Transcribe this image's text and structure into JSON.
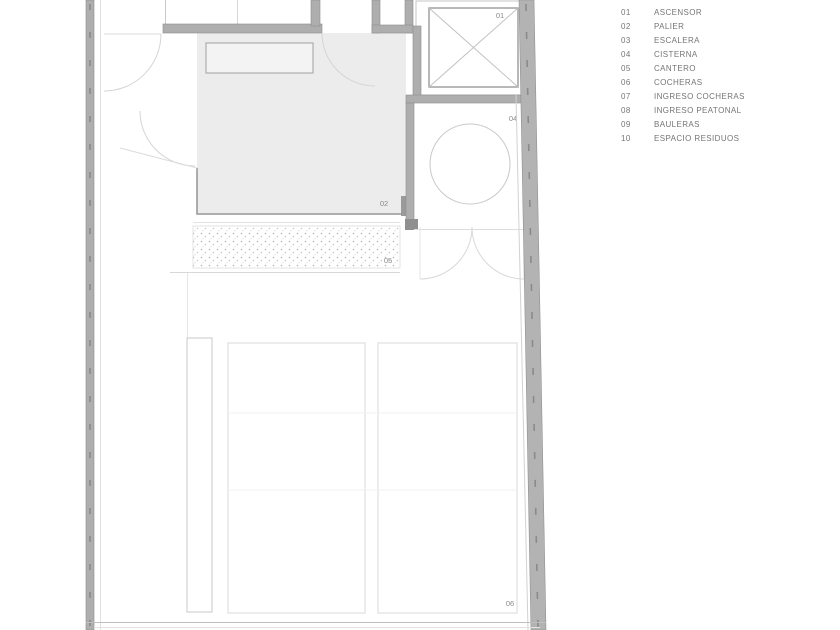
{
  "title": "Floor plan - ground level with garage",
  "legend": {
    "items": [
      {
        "num": "01",
        "label": "ASCENSOR"
      },
      {
        "num": "02",
        "label": "PALIER"
      },
      {
        "num": "03",
        "label": "ESCALERA"
      },
      {
        "num": "04",
        "label": "CISTERNA"
      },
      {
        "num": "05",
        "label": "CANTERO"
      },
      {
        "num": "06",
        "label": "COCHERAS"
      },
      {
        "num": "07",
        "label": "INGRESO COCHERAS"
      },
      {
        "num": "08",
        "label": "INGRESO PEATONAL"
      },
      {
        "num": "09",
        "label": "BAULERAS"
      },
      {
        "num": "10",
        "label": "ESPACIO RESIDUOS"
      }
    ]
  },
  "plan": {
    "labels": {
      "ascensor": "01",
      "palier": "02",
      "cisterna": "04",
      "cantero": "05",
      "cocheras": "06"
    }
  },
  "colors": {
    "wall_fill": "#aeaeae",
    "wall_edge": "#8c8c8c",
    "thin_line": "#c9c9c9",
    "faint_line": "#e2e2e2",
    "floor_grey": "#ececec",
    "label_text": "#8a8a8a",
    "legend_text": "#757575"
  }
}
